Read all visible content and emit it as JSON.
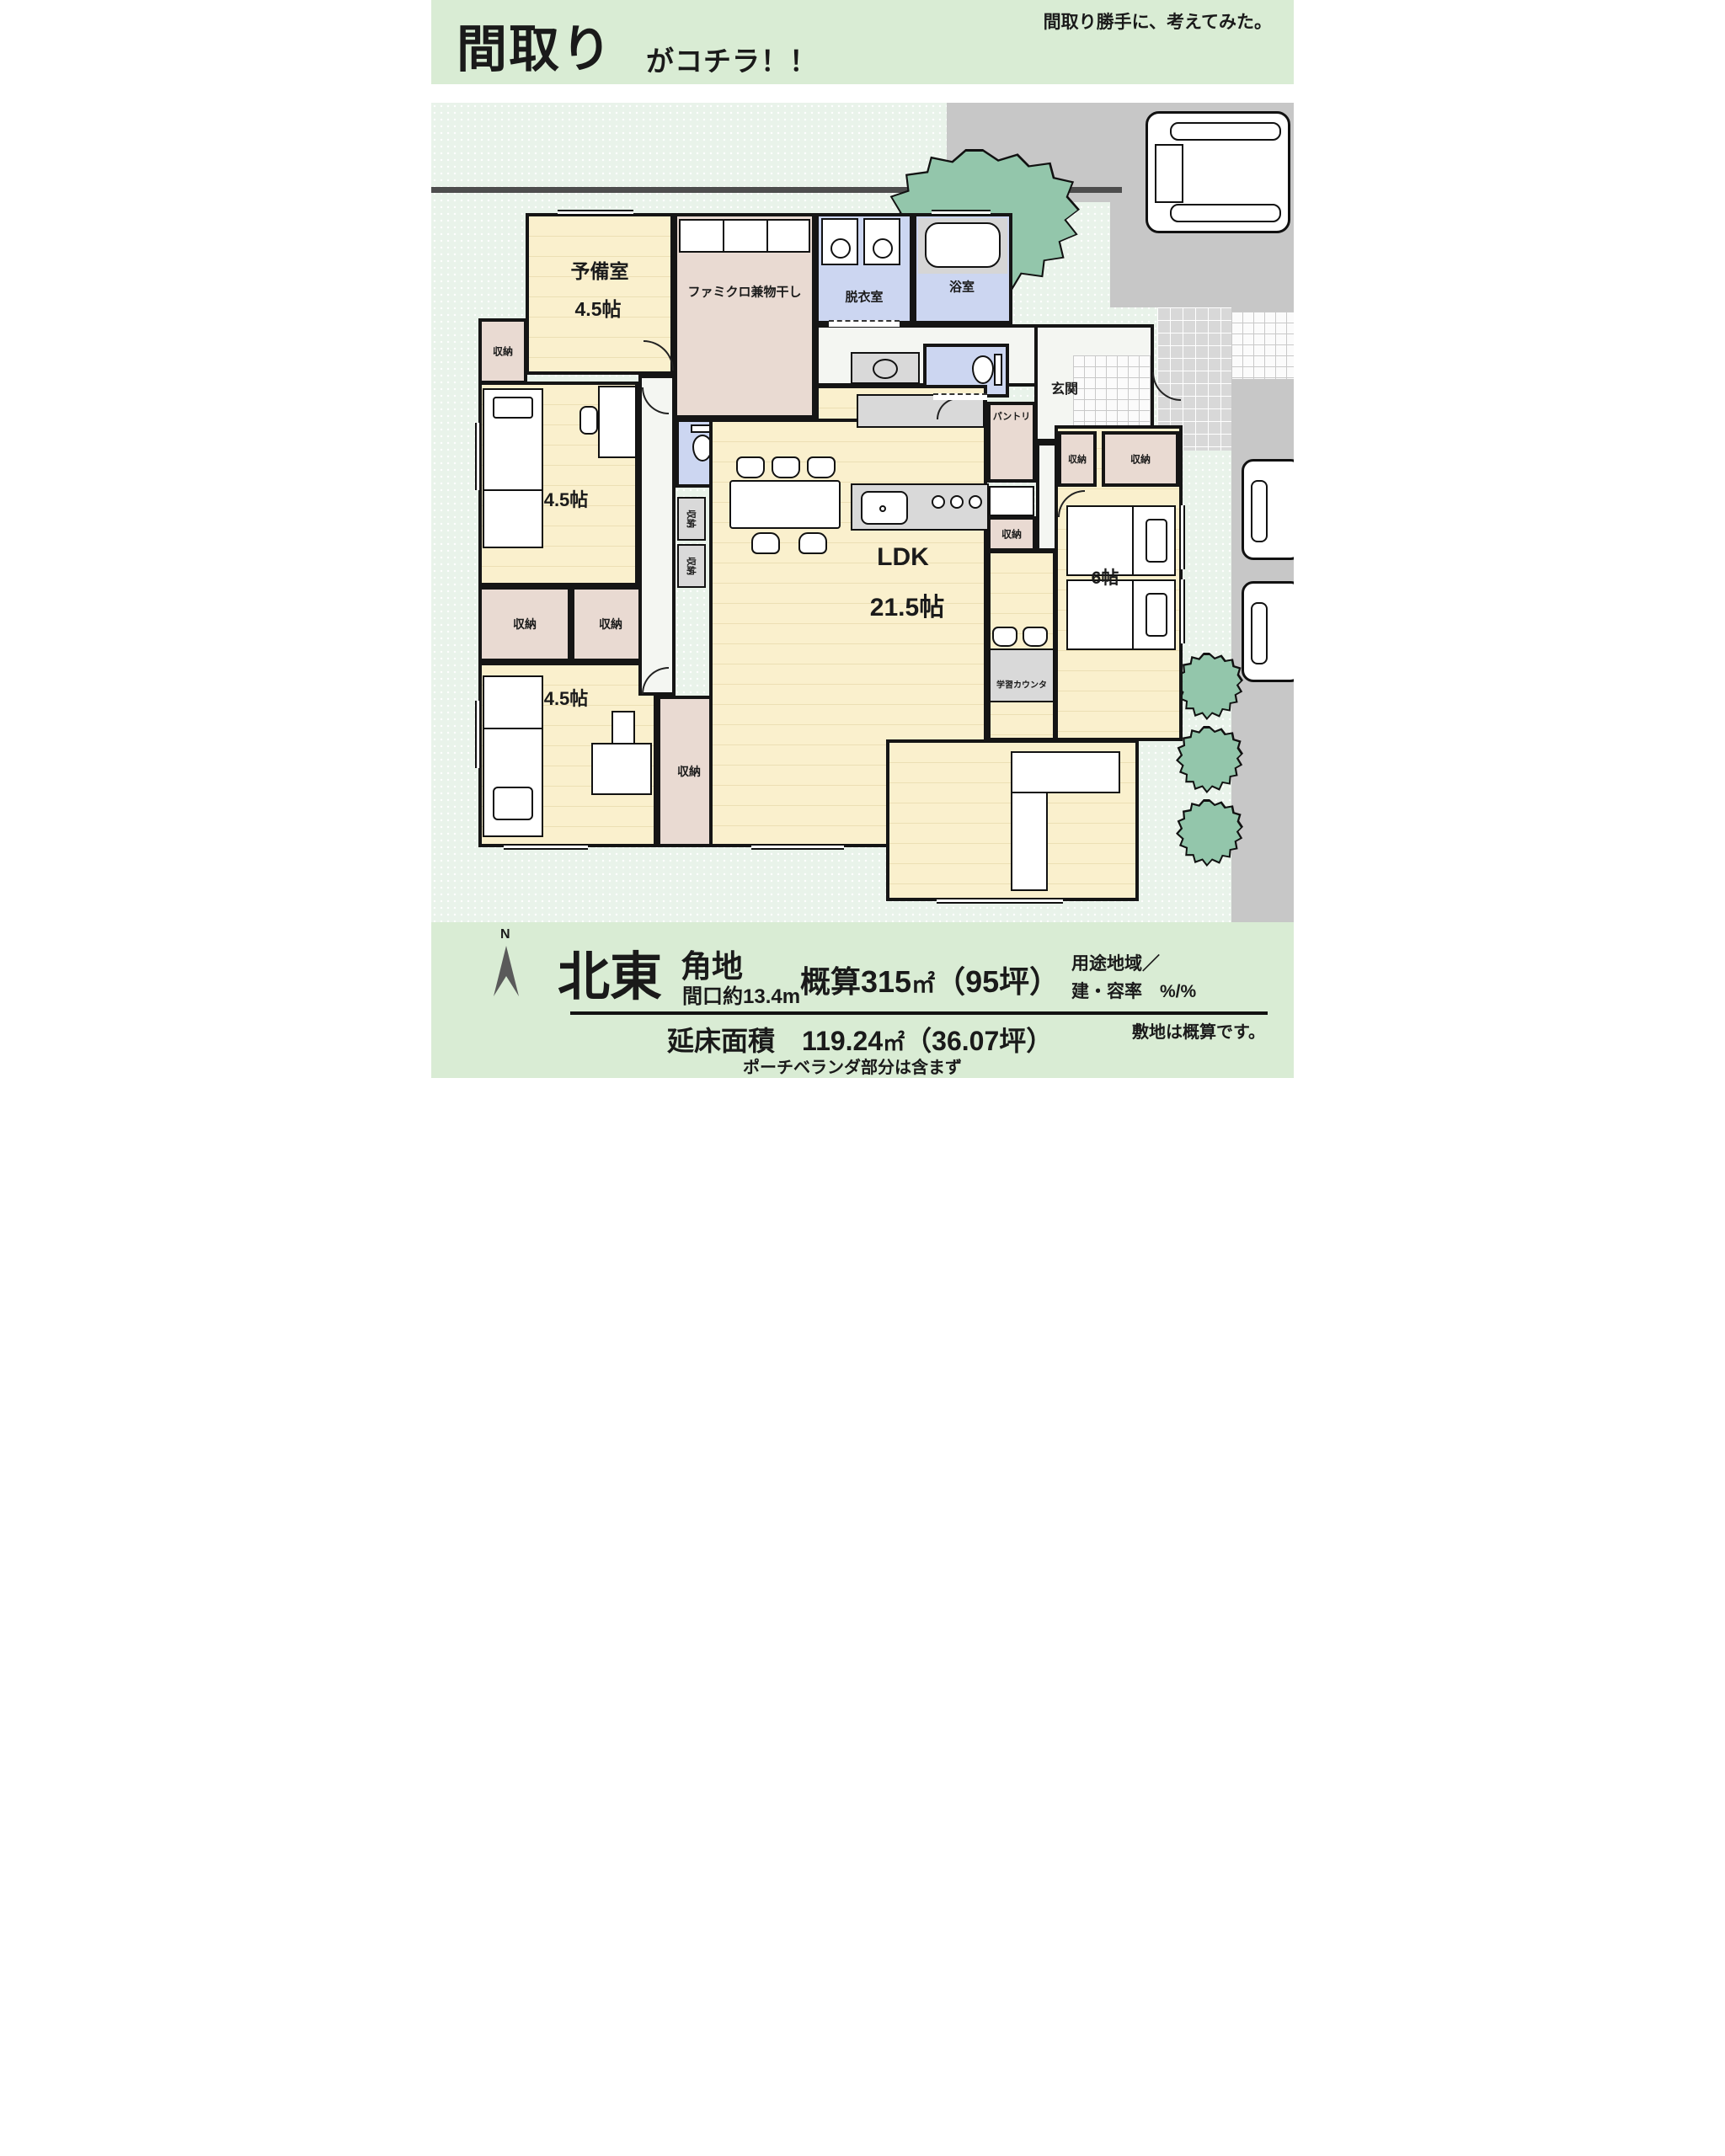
{
  "header": {
    "title_main": "間取り",
    "title_sub": "がコチラ！！",
    "tagline": "間取り勝手に、考えてみた。"
  },
  "plan": {
    "rooms": {
      "reserve": {
        "name": "予備室",
        "size": "4.5帖"
      },
      "famiclo": {
        "name": "ファミクロ兼物干し"
      },
      "dressing": {
        "name": "脱衣室"
      },
      "bath": {
        "name": "浴室"
      },
      "entrance": {
        "name": "玄関"
      },
      "bedroom_nw": {
        "size": "4.5帖"
      },
      "bedroom_sw": {
        "size": "4.5帖"
      },
      "tatami": {
        "size": "3帖"
      },
      "ldk": {
        "name": "LDK",
        "size": "21.5帖"
      },
      "bedroom_e": {
        "size": "6帖"
      },
      "pantry": {
        "name": "パントリ"
      },
      "study_counter": {
        "name": "学習カウンタ"
      }
    },
    "labels": {
      "closet": "収納"
    }
  },
  "footer": {
    "compass_n": "N",
    "direction": "北東",
    "corner": "角地",
    "frontage": "間口約13.4m",
    "site_area_prefix": "概算315",
    "site_area_unit": "㎡",
    "site_area_tsubo": "（95坪）",
    "zoning_line1": "用途地域／",
    "zoning_line2": "建・容率　%/%",
    "floor_area_label": "延床面積",
    "floor_area_value": "119.24",
    "floor_area_unit": "㎡",
    "floor_area_tsubo": "（36.07坪）",
    "note_porch": "ポーチベランダ部分は含まず",
    "note_site": "敷地は概算です。"
  },
  "colors": {
    "band_green": "#d9ecd4",
    "site_green": "#e9f3ea",
    "floor_cream": "#faf0cd",
    "closet_pink": "#e9dad2",
    "wet_blue": "#ccd6f1",
    "tatami_green": "#d9d8c1",
    "driveway_gray": "#c7c7c7",
    "tree_green": "#93c6ab",
    "wall_black": "#151515"
  }
}
